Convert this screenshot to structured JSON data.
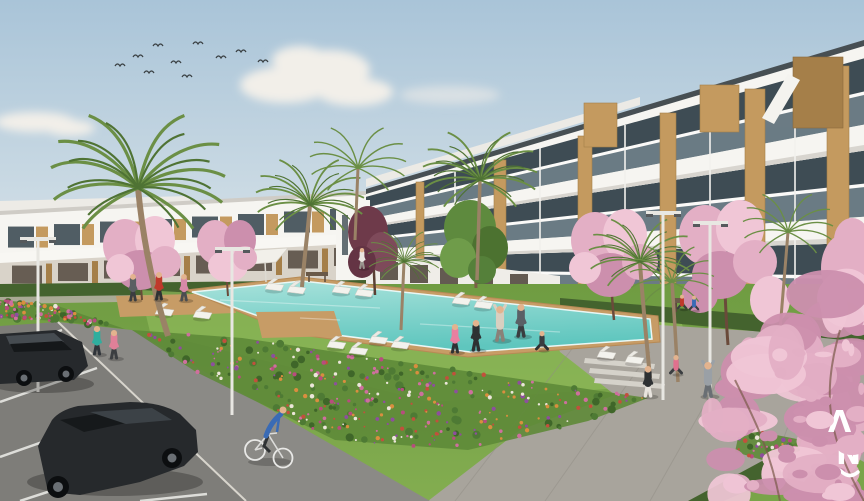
{
  "meta": {
    "type": "architectural-render",
    "description": "New-build Mediterranean apartment complex with communal lawn, swimming pool, flower beds, palm and cherry-blossom trees, residents exercising, a cyclist and a parking lot",
    "width": 864,
    "height": 501
  },
  "logo": {
    "glyph_top": "Λ",
    "glyph_bottom": "N",
    "underline": "~"
  },
  "palette": {
    "sky_top": "#a9c4d8",
    "sky_horizon": "#dde6ea",
    "cloud": "#f2efe9",
    "building_white": "#f6f5f1",
    "building_shade": "#e6e3dd",
    "glass_dark": "#3e4c54",
    "glass_light": "#8fa3ac",
    "wood": "#c49a5f",
    "wood_dark": "#a57f49",
    "roof_edge": "#474f53",
    "grass": "#79a449",
    "grass_light": "#8fb95a",
    "grass_dark": "#5e8a39",
    "hedge": "#44632e",
    "pool_far": "#a8e2db",
    "pool_near": "#5fc6be",
    "deck": "#c79c66",
    "path": "#8b8a86",
    "plaza": "#a8a49c",
    "asphalt": "#7e7d79",
    "line_white": "#e8e8e4",
    "trunk": "#9a8266",
    "palm": "#6b8f45",
    "palm_dark": "#4f7334",
    "car_body": "#26292c",
    "car_glass": "#15181a",
    "skin": "#e3b38e",
    "white": "#ffffff",
    "flowers": [
      "#d98e3f",
      "#ce6f9e",
      "#b84c7e",
      "#ece6da",
      "#c2503c",
      "#8e4e9e"
    ],
    "blossoms": [
      "#e3afc5",
      "#f0c6d6",
      "#cc8fad"
    ]
  },
  "scene": {
    "birds": [
      {
        "x": 138,
        "y": 57
      },
      {
        "x": 158,
        "y": 46
      },
      {
        "x": 176,
        "y": 63
      },
      {
        "x": 198,
        "y": 44
      },
      {
        "x": 221,
        "y": 58
      },
      {
        "x": 241,
        "y": 52
      },
      {
        "x": 149,
        "y": 73
      },
      {
        "x": 263,
        "y": 62
      },
      {
        "x": 187,
        "y": 77
      },
      {
        "x": 120,
        "y": 66
      }
    ],
    "people": [
      {
        "role": "resident",
        "x": 133,
        "y": 300,
        "h": 26,
        "shirt": "#5a5f63",
        "legs": "#3a3d40",
        "pose": "stand"
      },
      {
        "role": "resident",
        "x": 159,
        "y": 299,
        "h": 27,
        "shirt": "#c0392b",
        "legs": "#2e3133",
        "pose": "stand"
      },
      {
        "role": "resident",
        "x": 184,
        "y": 300,
        "h": 26,
        "shirt": "#d88aa8",
        "legs": "#4a4d50",
        "pose": "stand"
      },
      {
        "role": "jogger",
        "x": 97,
        "y": 354,
        "h": 28,
        "shirt": "#2fae9e",
        "legs": "#30353a",
        "pose": "stand"
      },
      {
        "role": "jogger",
        "x": 114,
        "y": 358,
        "h": 28,
        "shirt": "#e08098",
        "legs": "#3b3e41",
        "pose": "stand"
      },
      {
        "role": "walker",
        "x": 362,
        "y": 268,
        "h": 20,
        "shirt": "#eae6e0",
        "legs": "#9a958e",
        "pose": "stand"
      },
      {
        "role": "yoga",
        "x": 455,
        "y": 352,
        "h": 28,
        "shirt": "#e87fa0",
        "legs": "#2e3133",
        "pose": "stand"
      },
      {
        "role": "yoga",
        "x": 476,
        "y": 350,
        "h": 30,
        "shirt": "#2e3133",
        "legs": "#2e3133",
        "pose": "stand"
      },
      {
        "role": "yoga",
        "x": 500,
        "y": 340,
        "h": 34,
        "shirt": "#d9cfc0",
        "legs": "#8a8178",
        "pose": "raise"
      },
      {
        "role": "yoga",
        "x": 521,
        "y": 336,
        "h": 32,
        "shirt": "#5a6066",
        "legs": "#3a3d40",
        "pose": "stand"
      },
      {
        "role": "yoga",
        "x": 542,
        "y": 350,
        "h": 20,
        "shirt": "#3a3d40",
        "legs": "#2e3133",
        "pose": "sit"
      },
      {
        "role": "stretcher",
        "x": 648,
        "y": 396,
        "h": 30,
        "shirt": "#2e3133",
        "legs": "#e8e4de",
        "pose": "stand"
      },
      {
        "role": "stretcher",
        "x": 676,
        "y": 374,
        "h": 20,
        "shirt": "#e0708e",
        "legs": "#3a3d40",
        "pose": "sit"
      },
      {
        "role": "stretcher",
        "x": 708,
        "y": 396,
        "h": 34,
        "shirt": "#9aa0a6",
        "legs": "#6a6f74",
        "pose": "raise"
      },
      {
        "role": "bench-sitter",
        "x": 682,
        "y": 309,
        "h": 15,
        "shirt": "#c0392b",
        "legs": "#3a3d40",
        "pose": "sit"
      },
      {
        "role": "bench-sitter",
        "x": 694,
        "y": 310,
        "h": 15,
        "shirt": "#3a6bb5",
        "legs": "#3a3d40",
        "pose": "sit"
      }
    ],
    "loungers": [
      {
        "x": 158,
        "y": 308
      },
      {
        "x": 196,
        "y": 311
      },
      {
        "x": 268,
        "y": 283
      },
      {
        "x": 290,
        "y": 286
      },
      {
        "x": 335,
        "y": 286
      },
      {
        "x": 358,
        "y": 289
      },
      {
        "x": 455,
        "y": 297
      },
      {
        "x": 477,
        "y": 301
      },
      {
        "x": 330,
        "y": 341
      },
      {
        "x": 352,
        "y": 347
      },
      {
        "x": 372,
        "y": 336
      },
      {
        "x": 394,
        "y": 341
      },
      {
        "x": 600,
        "y": 351
      },
      {
        "x": 628,
        "y": 356
      }
    ],
    "flower_beds": [
      {
        "name": "left-strip",
        "points": [
          [
            0,
            300
          ],
          [
            55,
            305
          ],
          [
            125,
            329
          ],
          [
            58,
            321
          ],
          [
            0,
            318
          ]
        ],
        "blobs": 26,
        "dots": 70
      },
      {
        "name": "main-band",
        "points": [
          [
            132,
            330
          ],
          [
            242,
            338
          ],
          [
            648,
            398
          ],
          [
            588,
            421
          ],
          [
            468,
            450
          ],
          [
            335,
            440
          ],
          [
            196,
            372
          ]
        ],
        "blobs": 90,
        "dots": 270
      },
      {
        "name": "plaza-patch",
        "points": [
          [
            740,
            428
          ],
          [
            802,
            440
          ],
          [
            790,
            468
          ],
          [
            735,
            452
          ]
        ],
        "blobs": 10,
        "dots": 34
      }
    ],
    "corner_blossoms": {
      "points": [
        [
          700,
          501
        ],
        [
          706,
          424
        ],
        [
          752,
          330
        ],
        [
          832,
          288
        ],
        [
          864,
          288
        ],
        [
          864,
          501
        ]
      ],
      "count": 48
    }
  }
}
